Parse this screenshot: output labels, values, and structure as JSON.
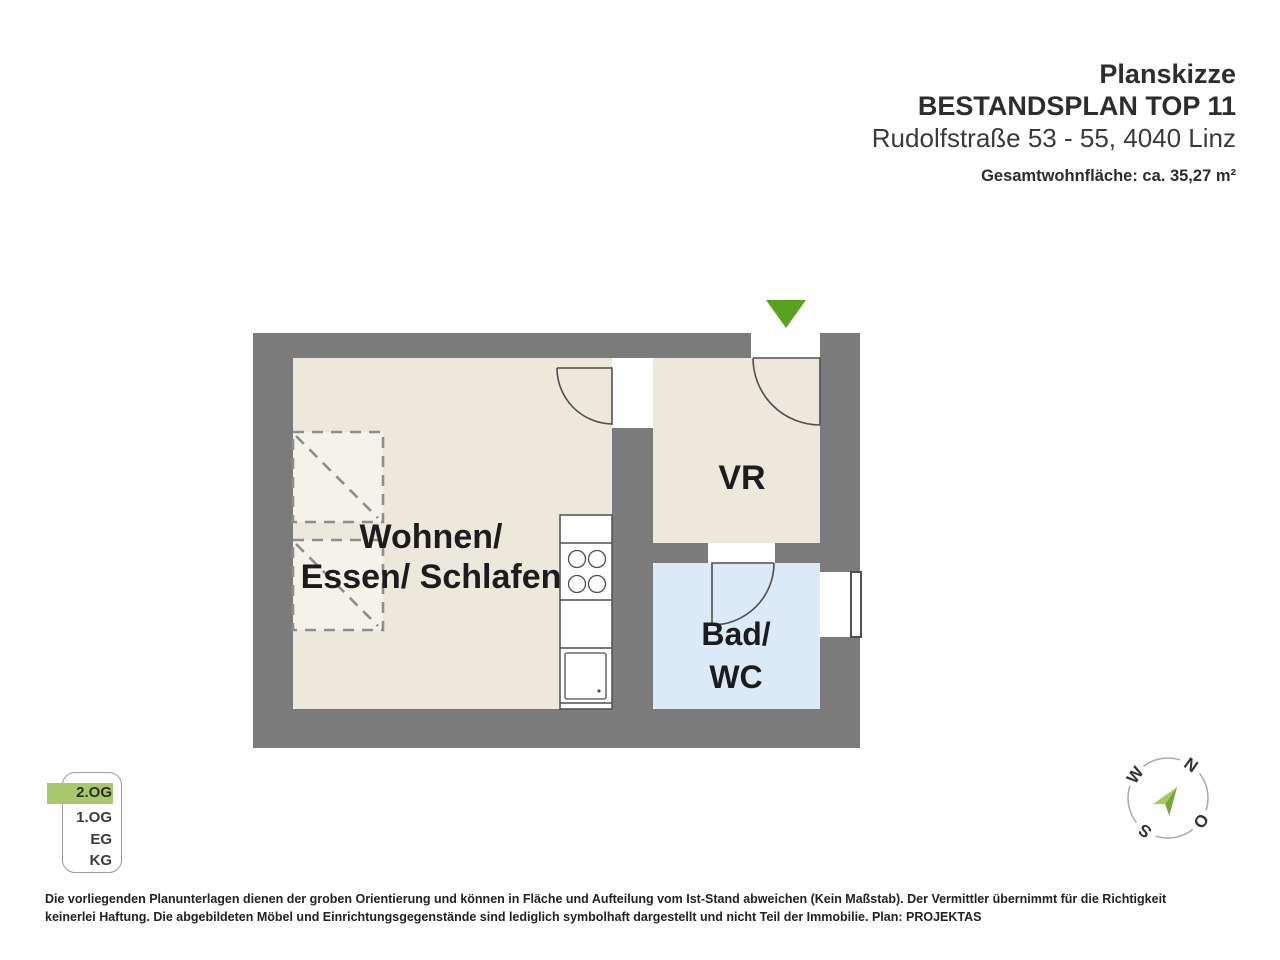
{
  "header": {
    "title": "Planskizze",
    "plan_name": "BESTANDSPLAN TOP 11",
    "address": "Rudolfstraße 53 - 55, 4040 Linz",
    "total_area": "Gesamtwohnfläche: ca. 35,27 m²"
  },
  "rooms": {
    "living": {
      "line1": "Wohnen/",
      "line2": "Essen/ Schlafen"
    },
    "hallway": {
      "label": "VR"
    },
    "bathroom": {
      "line1": "Bad/",
      "line2": "WC"
    }
  },
  "floor_selector": {
    "floors": [
      {
        "label": "2.OG",
        "active": true
      },
      {
        "label": "1.OG",
        "active": false
      },
      {
        "label": "EG",
        "active": false
      },
      {
        "label": "KG",
        "active": false
      }
    ]
  },
  "compass": {
    "north": "N",
    "east": "O",
    "south": "S",
    "west": "W"
  },
  "disclaimer": {
    "line1": "Die vorliegenden Planunterlagen dienen der groben Orientierung und können in Fläche und Aufteilung vom Ist-Stand abweichen (Kein Maßstab). Der Vermittler übernimmt für die Richtigkeit",
    "line2": "keinerlei Haftung. Die abgebildeten Möbel und Einrichtungsgegenstände sind lediglich symbolhaft dargestellt und nicht Teil der Immobilie. Plan: PROJEKTAS"
  },
  "colors": {
    "wall_gray": "#7b7b7b",
    "room_beige": "#ede8dc",
    "bath_blue": "#dceaf7",
    "furniture_fill": "#f5f2ea",
    "arrow_green": "#5aa21e",
    "floor_highlight_green": "#a9c86d",
    "door_line": "#4f4f4f"
  }
}
